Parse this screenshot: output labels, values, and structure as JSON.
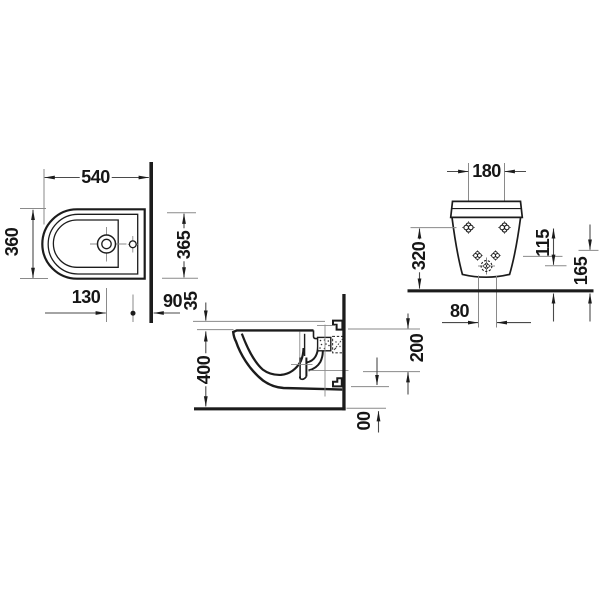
{
  "drawing": {
    "type": "technical-drawing",
    "subject": "wall-mounted bidet, three orthographic views",
    "dims": {
      "plan_width": "540",
      "plan_depth": "360",
      "plan_depth_wall": "365",
      "plan_tap": "130",
      "plan_rear": "90",
      "side_rim": "35",
      "side_height": "400",
      "side_drain": "200",
      "side_floor": "00",
      "front_spacing": "180",
      "front_height": "320",
      "front_offset_a": "115",
      "front_offset_b": "165",
      "front_holes": "80"
    },
    "colors": {
      "line": "#1c1c1c",
      "dim_line": "#4a4a4a",
      "thin_line": "#8a8a8a",
      "background": "#ffffff"
    }
  }
}
